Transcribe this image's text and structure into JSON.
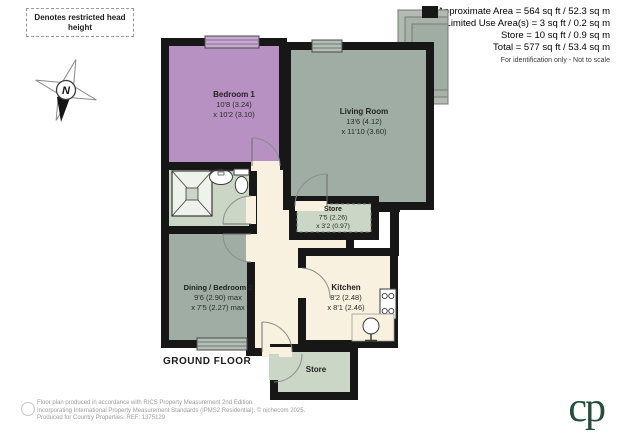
{
  "legend": {
    "label": "Denotes restricted head height"
  },
  "compass": {
    "north_label": "N"
  },
  "area_summary": {
    "lines": [
      "Approximate Area = 564 sq ft / 52.3 sq m",
      "Limited Use Area(s) = 3 sq ft / 0.2 sq m",
      "Store = 10 sq ft / 0.9 sq m",
      "Total = 577 sq ft / 53.4 sq m"
    ],
    "disclaimer": "For identification only - Not to scale"
  },
  "rooms": {
    "bedroom1": {
      "name": "Bedroom 1",
      "dim1": "10'8 (3.24)",
      "dim2": "x 10'2 (3.10)"
    },
    "living_room": {
      "name": "Living Room",
      "dim1": "13'6 (4.12)",
      "dim2": "x 11'10 (3.60)"
    },
    "store_top": {
      "name": "Store",
      "dim1": "7'5 (2.26)",
      "dim2": "x 3'2 (0.97)"
    },
    "dining_bedroom2": {
      "name": "Dining / Bedroom 2",
      "dim1": "9'6 (2.90) max",
      "dim2": "x 7'5 (2.27) max"
    },
    "kitchen": {
      "name": "Kitchen",
      "dim1": "8'2 (2.48)",
      "dim2": "x 8'1 (2.46)"
    },
    "store_bottom": {
      "name": "Store"
    }
  },
  "floor_label": "GROUND FLOOR",
  "footer": {
    "line1": "Floor plan produced in accordance with RICS Property Measurement 2nd Edition.",
    "line2": "Incorporating International Property Measurement Standards (IPMS2 Residential). © nichecom 2025.",
    "line3": "Produced for Country Properties.   REF: 1375129"
  },
  "logo": {
    "text": "cp"
  },
  "colors": {
    "bedroom": "#b691c1",
    "living_room": "#a0ada5",
    "sage": "#ccd6c6",
    "cream": "#f8f1df",
    "wall": "#171717",
    "logo_green": "#23503d"
  }
}
